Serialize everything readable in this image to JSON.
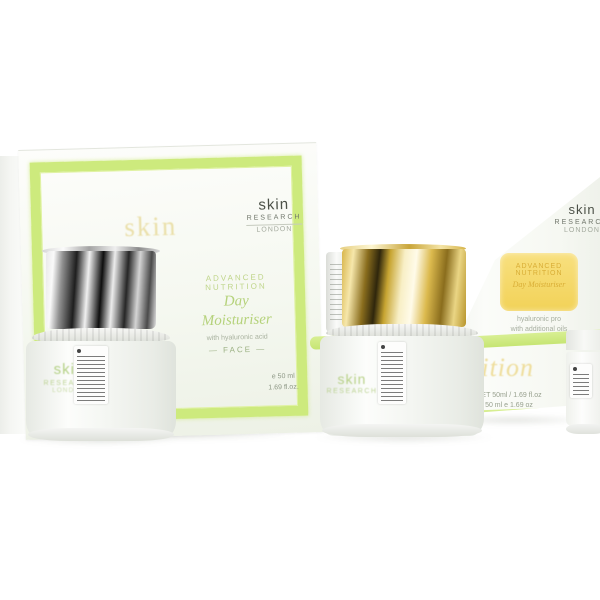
{
  "scene": "skin RESEARCH skincare gift set product photograph",
  "background_color": "#ffffff",
  "palette": {
    "lime": "#cdea7d",
    "lime_soft": "#e4f3ad",
    "box_face": "#f6f8f1",
    "gold_lid": "#d9b648",
    "chrome_dark": "#1d1d1d",
    "yellow_label": "#f5d96e",
    "green_text": "#b5d27b",
    "logo_dark": "#4b5047",
    "muted_gray": "#98a18f",
    "watermark_gold": "#eadfa9"
  },
  "gift_box": {
    "watermark": "skin",
    "logo": {
      "name": "skin",
      "line2": "RESEARCH",
      "line3": "LONDON"
    },
    "title_small_1": "ADVANCED",
    "title_small_2": "NUTRITION",
    "title_big_1": "Day",
    "title_big_2": "Moisturiser",
    "subtitle": "with hyaluronic acid",
    "category": "— FACE —",
    "size_1": "e 50 ml",
    "size_2": "1.69 fl.oz."
  },
  "silver_jar": {
    "logo": {
      "name": "skin",
      "line2": "RESEARCH",
      "line3": "LONDON"
    }
  },
  "gold_jar": {
    "logo": {
      "name": "skin",
      "line2": "RESEARCH"
    }
  },
  "right_box": {
    "logo": {
      "name": "skin",
      "line2": "RESEARCH",
      "line3": "LONDON"
    },
    "label_line_1": "ADVANCED",
    "label_line_2": "NUTRITION",
    "label_line_3": "Day Moisturiser",
    "sub_line_1": "hyaluronic pro",
    "sub_line_2": "with additional oils",
    "watermark": "nutrition",
    "size_1": "NET 50ml / 1.69 fl.oz",
    "size_2": "50 ml e 1.69 oz"
  }
}
